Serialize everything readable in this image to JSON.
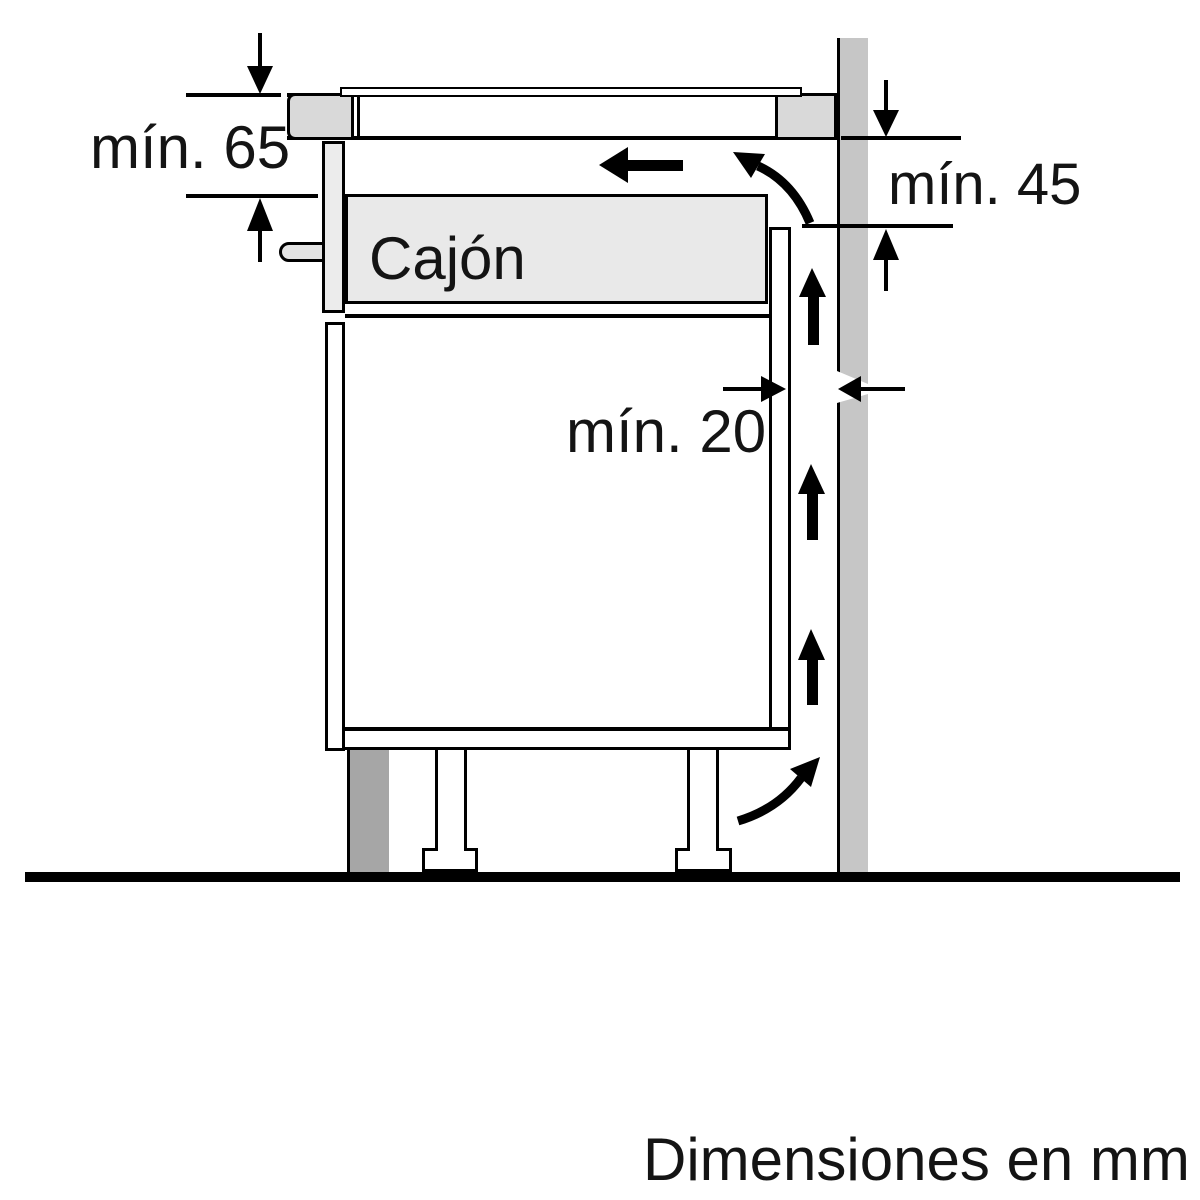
{
  "diagram": {
    "type": "installation-clearance-side-view",
    "labels": {
      "clearance_worktop_to_drawer": "mín. 65",
      "clearance_hob_to_cabinet": "mín. 45",
      "clearance_wall_gap": "mín. 20",
      "drawer": "Cajón",
      "units_note": "Dimensiones en mm"
    },
    "colors": {
      "background": "#ffffff",
      "line": "#000000",
      "wall": "#c6c6c6",
      "plinth": "#a6a6a6",
      "worktop_end": "#d9d9d9",
      "drawer_fill": "#e9e9e9"
    }
  }
}
